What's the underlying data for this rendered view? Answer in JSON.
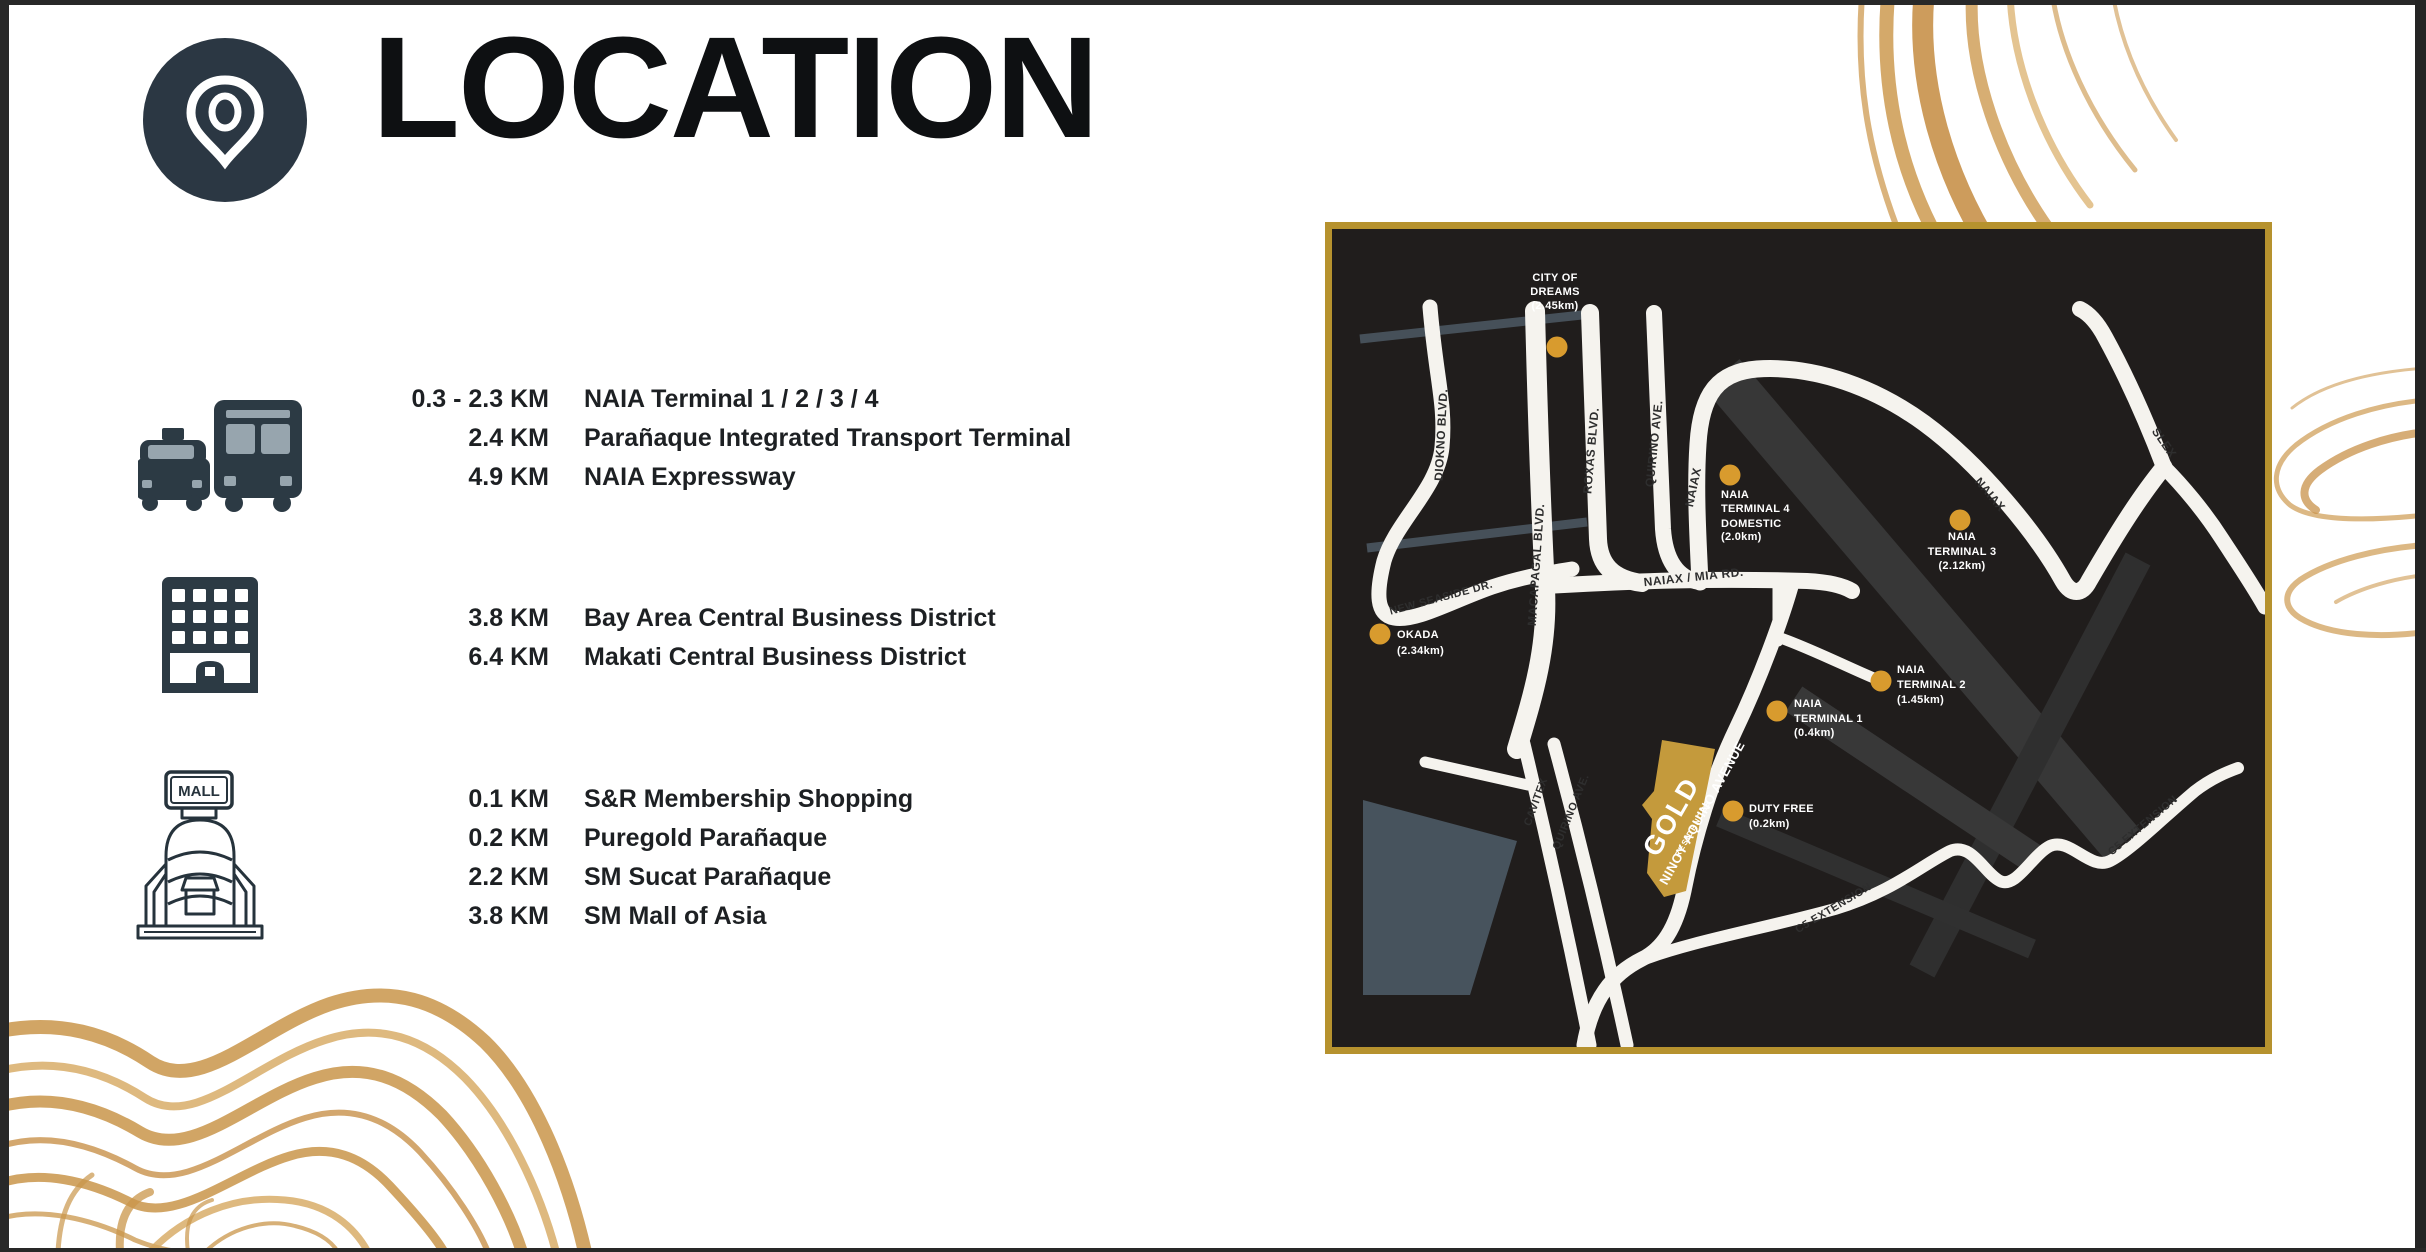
{
  "title": "LOCATION",
  "groups": [
    {
      "icon": "transport",
      "items": [
        {
          "distance": "0.3 - 2.3 KM",
          "name": "NAIA Terminal 1 / 2 / 3 / 4"
        },
        {
          "distance": "2.4 KM",
          "name": "Parañaque Integrated Transport Terminal"
        },
        {
          "distance": "4.9 KM",
          "name": "NAIA Expressway"
        }
      ]
    },
    {
      "icon": "office-building",
      "items": [
        {
          "distance": "3.8 KM",
          "name": "Bay Area Central Business District"
        },
        {
          "distance": "6.4 KM",
          "name": "Makati Central Business District"
        }
      ]
    },
    {
      "icon": "shopping-mall",
      "items": [
        {
          "distance": "0.1 KM",
          "name": "S&R Membership Shopping"
        },
        {
          "distance": "0.2 KM",
          "name": "Puregold Parañaque"
        },
        {
          "distance": "2.2 KM",
          "name": "SM Sucat Parañaque"
        },
        {
          "distance": "3.8 KM",
          "name": "SM Mall of Asia"
        }
      ]
    }
  ],
  "icons": {
    "mall_sign": "MALL"
  },
  "map": {
    "landmarks": [
      {
        "id": "city-of-dreams",
        "lines": [
          "CITY OF",
          "DREAMS",
          "(2.45km)"
        ]
      },
      {
        "id": "naia-terminal-4",
        "lines": [
          "NAIA",
          "TERMINAL 4",
          "DOMESTIC",
          "(2.0km)"
        ]
      },
      {
        "id": "naia-terminal-3",
        "lines": [
          "NAIA",
          "TERMINAL 3",
          "(2.12km)"
        ]
      },
      {
        "id": "okada",
        "lines": [
          "OKADA",
          "(2.34km)"
        ]
      },
      {
        "id": "naia-terminal-2",
        "lines": [
          "NAIA",
          "TERMINAL 2",
          "(1.45km)"
        ]
      },
      {
        "id": "naia-terminal-1",
        "lines": [
          "NAIA",
          "TERMINAL 1",
          "(0.4km)"
        ]
      },
      {
        "id": "duty-free",
        "lines": [
          "DUTY FREE",
          "(0.2km)"
        ]
      }
    ],
    "road_labels": {
      "diokno": "DIOKNO BLVD.",
      "macapagal": "MACAPAGAL BLVD.",
      "roxas": "ROXAS BLVD.",
      "quirino_top": "QUIRINO AVE.",
      "naiax_top": "NAIAX",
      "naiax_mia": "NAIAX / MIA RD.",
      "new_seaside": "NEW SEASIDE DR.",
      "naiax_diag": "NAIAX",
      "slex": "SLEX",
      "cavitex": "CAVITEX",
      "quirino_bottom": "QUIRINO AVE.",
      "ninoy_aquino": "NINOY AQUINO AVENUE",
      "c5_center": "C5 EXTENSION",
      "c5_right": "C5 EXTENSION"
    },
    "property": {
      "name": "GOLD",
      "subname": "RESIDENCES"
    }
  },
  "colors": {
    "frame_gold": "#b6922e",
    "marker_gold": "#d89b2e",
    "building_gold": "#c49a3c",
    "icon_slate": "#2c3a44",
    "map_background": "#201d1c",
    "swirl_gold": "#cd9a50"
  }
}
